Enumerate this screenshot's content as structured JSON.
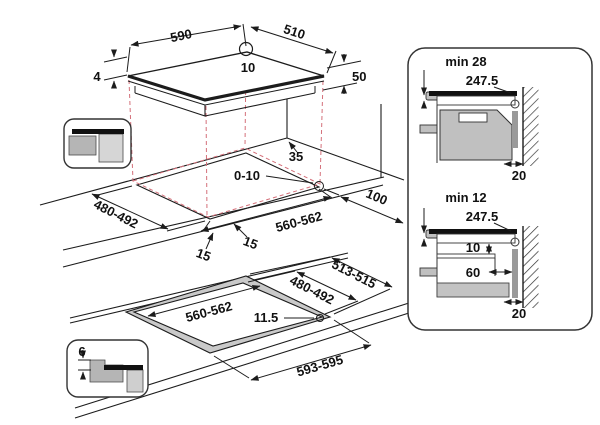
{
  "title": "hob-installation-diagram",
  "colors": {
    "line": "#1c1c1c",
    "projection_red": "#d4707a",
    "oven_gray": "#c0c0c0",
    "light_gray": "#d6d6d6",
    "mid_gray": "#b5b5b5",
    "rim_gray": "#c9c9c9",
    "spacer_gray": "#9a9a9a"
  },
  "hob_view": {
    "dim_width": "590",
    "dim_depth": "510",
    "dim_hole": "10",
    "dim_glass_thickness": "4",
    "dim_body_height": "50"
  },
  "worktop_scene": {
    "dim_rear_gap": "35",
    "dim_overhang": "0-10",
    "dim_cutout_depth": "480-492",
    "dim_margin_left": "15",
    "dim_margin_front": "15",
    "dim_cutout_width": "560-562",
    "dim_side_gap": "100"
  },
  "flush_scene": {
    "dim_outer_depth": "513-515",
    "dim_inner_depth": "480-492",
    "dim_inner_width": "560-562",
    "dim_rebate_width": "11.5",
    "dim_outer_width": "593-595"
  },
  "flush_inset": {
    "dim_rebate_depth": "6"
  },
  "side_panel": {
    "top_section": {
      "clearance": "min 28",
      "dim_width": "247.5",
      "dim_wall_gap": "20"
    },
    "bottom_section": {
      "clearance": "min 12",
      "dim_width": "247.5",
      "dim_shelf_gap": "10",
      "dim_shelf_inset": "60",
      "dim_wall_gap": "20"
    }
  }
}
